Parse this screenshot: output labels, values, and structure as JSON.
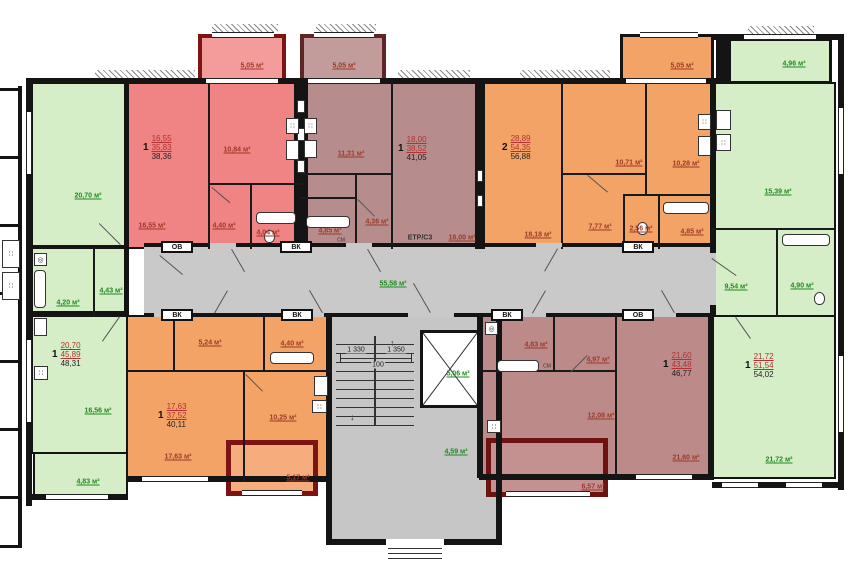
{
  "apts": {
    "a1": {
      "count": "1",
      "living": "16,55",
      "total": "35,83",
      "overall": "38,36"
    },
    "a2": {
      "count": "1",
      "living": "18,00",
      "total": "38,52",
      "overall": "41,05"
    },
    "a3": {
      "count": "2",
      "living": "28,89",
      "total": "54,35",
      "overall": "56,88"
    },
    "a4": {
      "count": "1",
      "living": "20,70",
      "total": "45,89",
      "overall": "48,31"
    },
    "a5": {
      "count": "1",
      "living": "17,63",
      "total": "37,52",
      "overall": "40,11"
    },
    "a6": {
      "count": "1",
      "living": "21,60",
      "total": "43,48",
      "overall": "46,77"
    },
    "a7": {
      "count": "1",
      "living": "21,72",
      "total": "51,54",
      "overall": "54,02"
    }
  },
  "areas": {
    "a1_living": "16,55 м²",
    "a1_kitchen": "10,84 м²",
    "a1_hall": "4,40 м²",
    "a1_bath": "4,04 м²",
    "a1_balcony": "5,05 м²",
    "a2_kitchen": "11,31 м²",
    "a2_living": "18,00 м²",
    "a2_hall": "4,36 м²",
    "a2_bath": "4,85 м²",
    "a2_balcony": "5,05 м²",
    "a3_room1": "18,18 м²",
    "a3_room2": "10,71 м²",
    "a3_kitchen": "10,28 м²",
    "a3_hall": "7,77 м²",
    "a3_wc": "2,56 м²",
    "a3_bath": "4,85 м²",
    "a3_balcony": "5,05 м²",
    "a4_living": "20,70 м²",
    "a4_bath": "4,20 м²",
    "a4_hall": "4,43 м²",
    "a4_kitchen": "16,56 м²",
    "a4_balcony": "4,83 м²",
    "a5_hall": "5,24 м²",
    "a5_bath": "4,40 м²",
    "a5_kitchen": "10,25 м²",
    "a5_living": "17,63 м²",
    "a5_balcony": "5,17 м²",
    "a6_bath": "4,83 м²",
    "a6_hall": "4,97 м²",
    "a6_kitchen": "12,08 м²",
    "a6_living": "21,60 м²",
    "a6_balcony": "6,57 м²",
    "a7_balcony": "4,96 м²",
    "a7_living": "15,39 м²",
    "a7_hall": "9,54 м²",
    "a7_bath": "4,90 м²",
    "a7_room": "21,72 м²",
    "corridor": "55,58 м²",
    "elevator": "5,06 м²",
    "vestibule": "4,59 м²"
  },
  "misc": {
    "etr": "ЕТР/С3",
    "vk": "ВК",
    "ov": "ОВ",
    "sm": "СМ",
    "dim_left": "1 330",
    "dim_mid": "100",
    "dim_right": "1 350"
  },
  "icons": {
    "stove": "∷",
    "washer": "◎"
  }
}
